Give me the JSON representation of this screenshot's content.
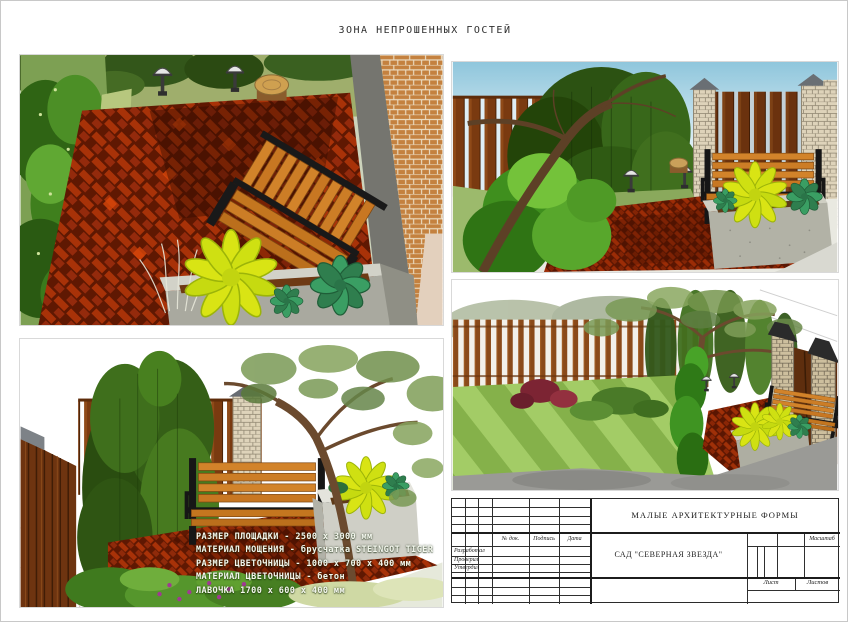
{
  "page": {
    "title": "ЗОНА НЕПРОШЕННЫХ ГОСТЕЙ"
  },
  "specs": {
    "lines": [
      "РАЗМЕР ПЛОЩАДКИ - 2500 х 3000 мм",
      "МАТЕРИАЛ МОЩЕНИЯ - брусчатка STEINGOT TIGER",
      "РАЗМЕР ЦВЕТОЧНИЦЫ - 1000 х 700 х 400 мм",
      "МАТЕРИАЛ ЦВЕТОЧНИЦЫ - бетон",
      "ЛАВОЧКА 1700 х 600 х 400 мм"
    ]
  },
  "title_block": {
    "section_title": "МАЛЫЕ АРХИТЕКТУРНЫЕ ФОРМЫ",
    "project_name": "САД \"СЕВЕРНАЯ ЗВЕЗДА\"",
    "col_headers": {
      "doc": "№ док.",
      "signature": "Подпись",
      "date": "Дата"
    },
    "roles": [
      "Разработал",
      "Проверил",
      "Утвердил"
    ],
    "scale_label": "Масштаб",
    "sheet_label": "Лист",
    "sheets_label": "Листов"
  },
  "colors": {
    "paving_red": "#a83208",
    "paving_dark": "#5f1802",
    "bench_wood": "#d2832a",
    "bench_frame": "#161616",
    "planter_concrete": "#b2b2a6",
    "plant_yellow": "#d9e414",
    "plant_teal": "#3a9e63",
    "hedge_green": "#2e5a14",
    "fence_brown": "#7a3a10",
    "brick_tan": "#d8cdb4",
    "lawn_green": "#8fbf56",
    "sky_blue": "#8fc6dc"
  }
}
